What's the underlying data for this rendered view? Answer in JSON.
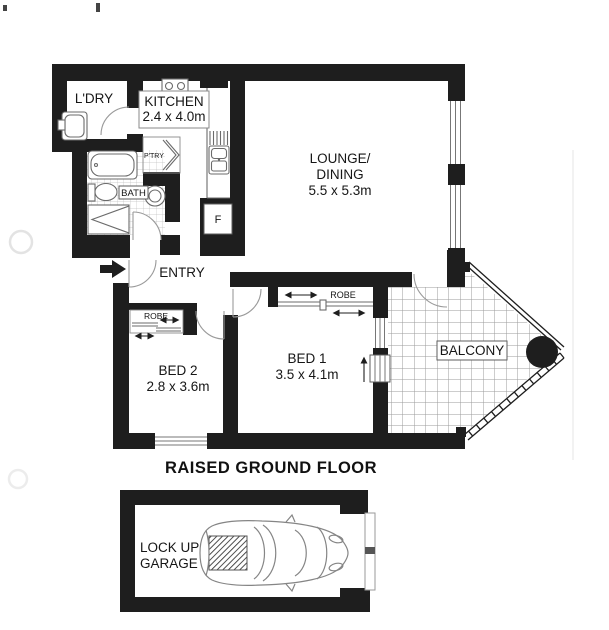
{
  "plan": {
    "caption": "RAISED GROUND FLOOR",
    "labels": {
      "laundry": "L'DRY",
      "kitchen_name": "KITCHEN",
      "kitchen_dims": "2.4 x 4.0m",
      "pantry": "P'TRY",
      "bath": "BATH",
      "fridge": "F",
      "lounge_line1": "LOUNGE/",
      "lounge_line2": "DINING",
      "lounge_dims": "5.5 x 5.3m",
      "entry": "ENTRY",
      "bed1_name": "BED 1",
      "bed1_dims": "3.5 x 4.1m",
      "bed1_robe": "ROBE",
      "bed2_name": "BED 2",
      "bed2_dims": "2.8 x 3.6m",
      "bed2_robe": "ROBE",
      "balcony": "BALCONY",
      "garage_line1": "LOCK UP",
      "garage_line2": "GARAGE"
    },
    "colors": {
      "wall": "#1e1e1e",
      "fixture_line": "#6b6b6b",
      "tile_line": "#c2c2c2",
      "balcony_grid": "#9b9b9b",
      "background": "#ffffff"
    }
  }
}
